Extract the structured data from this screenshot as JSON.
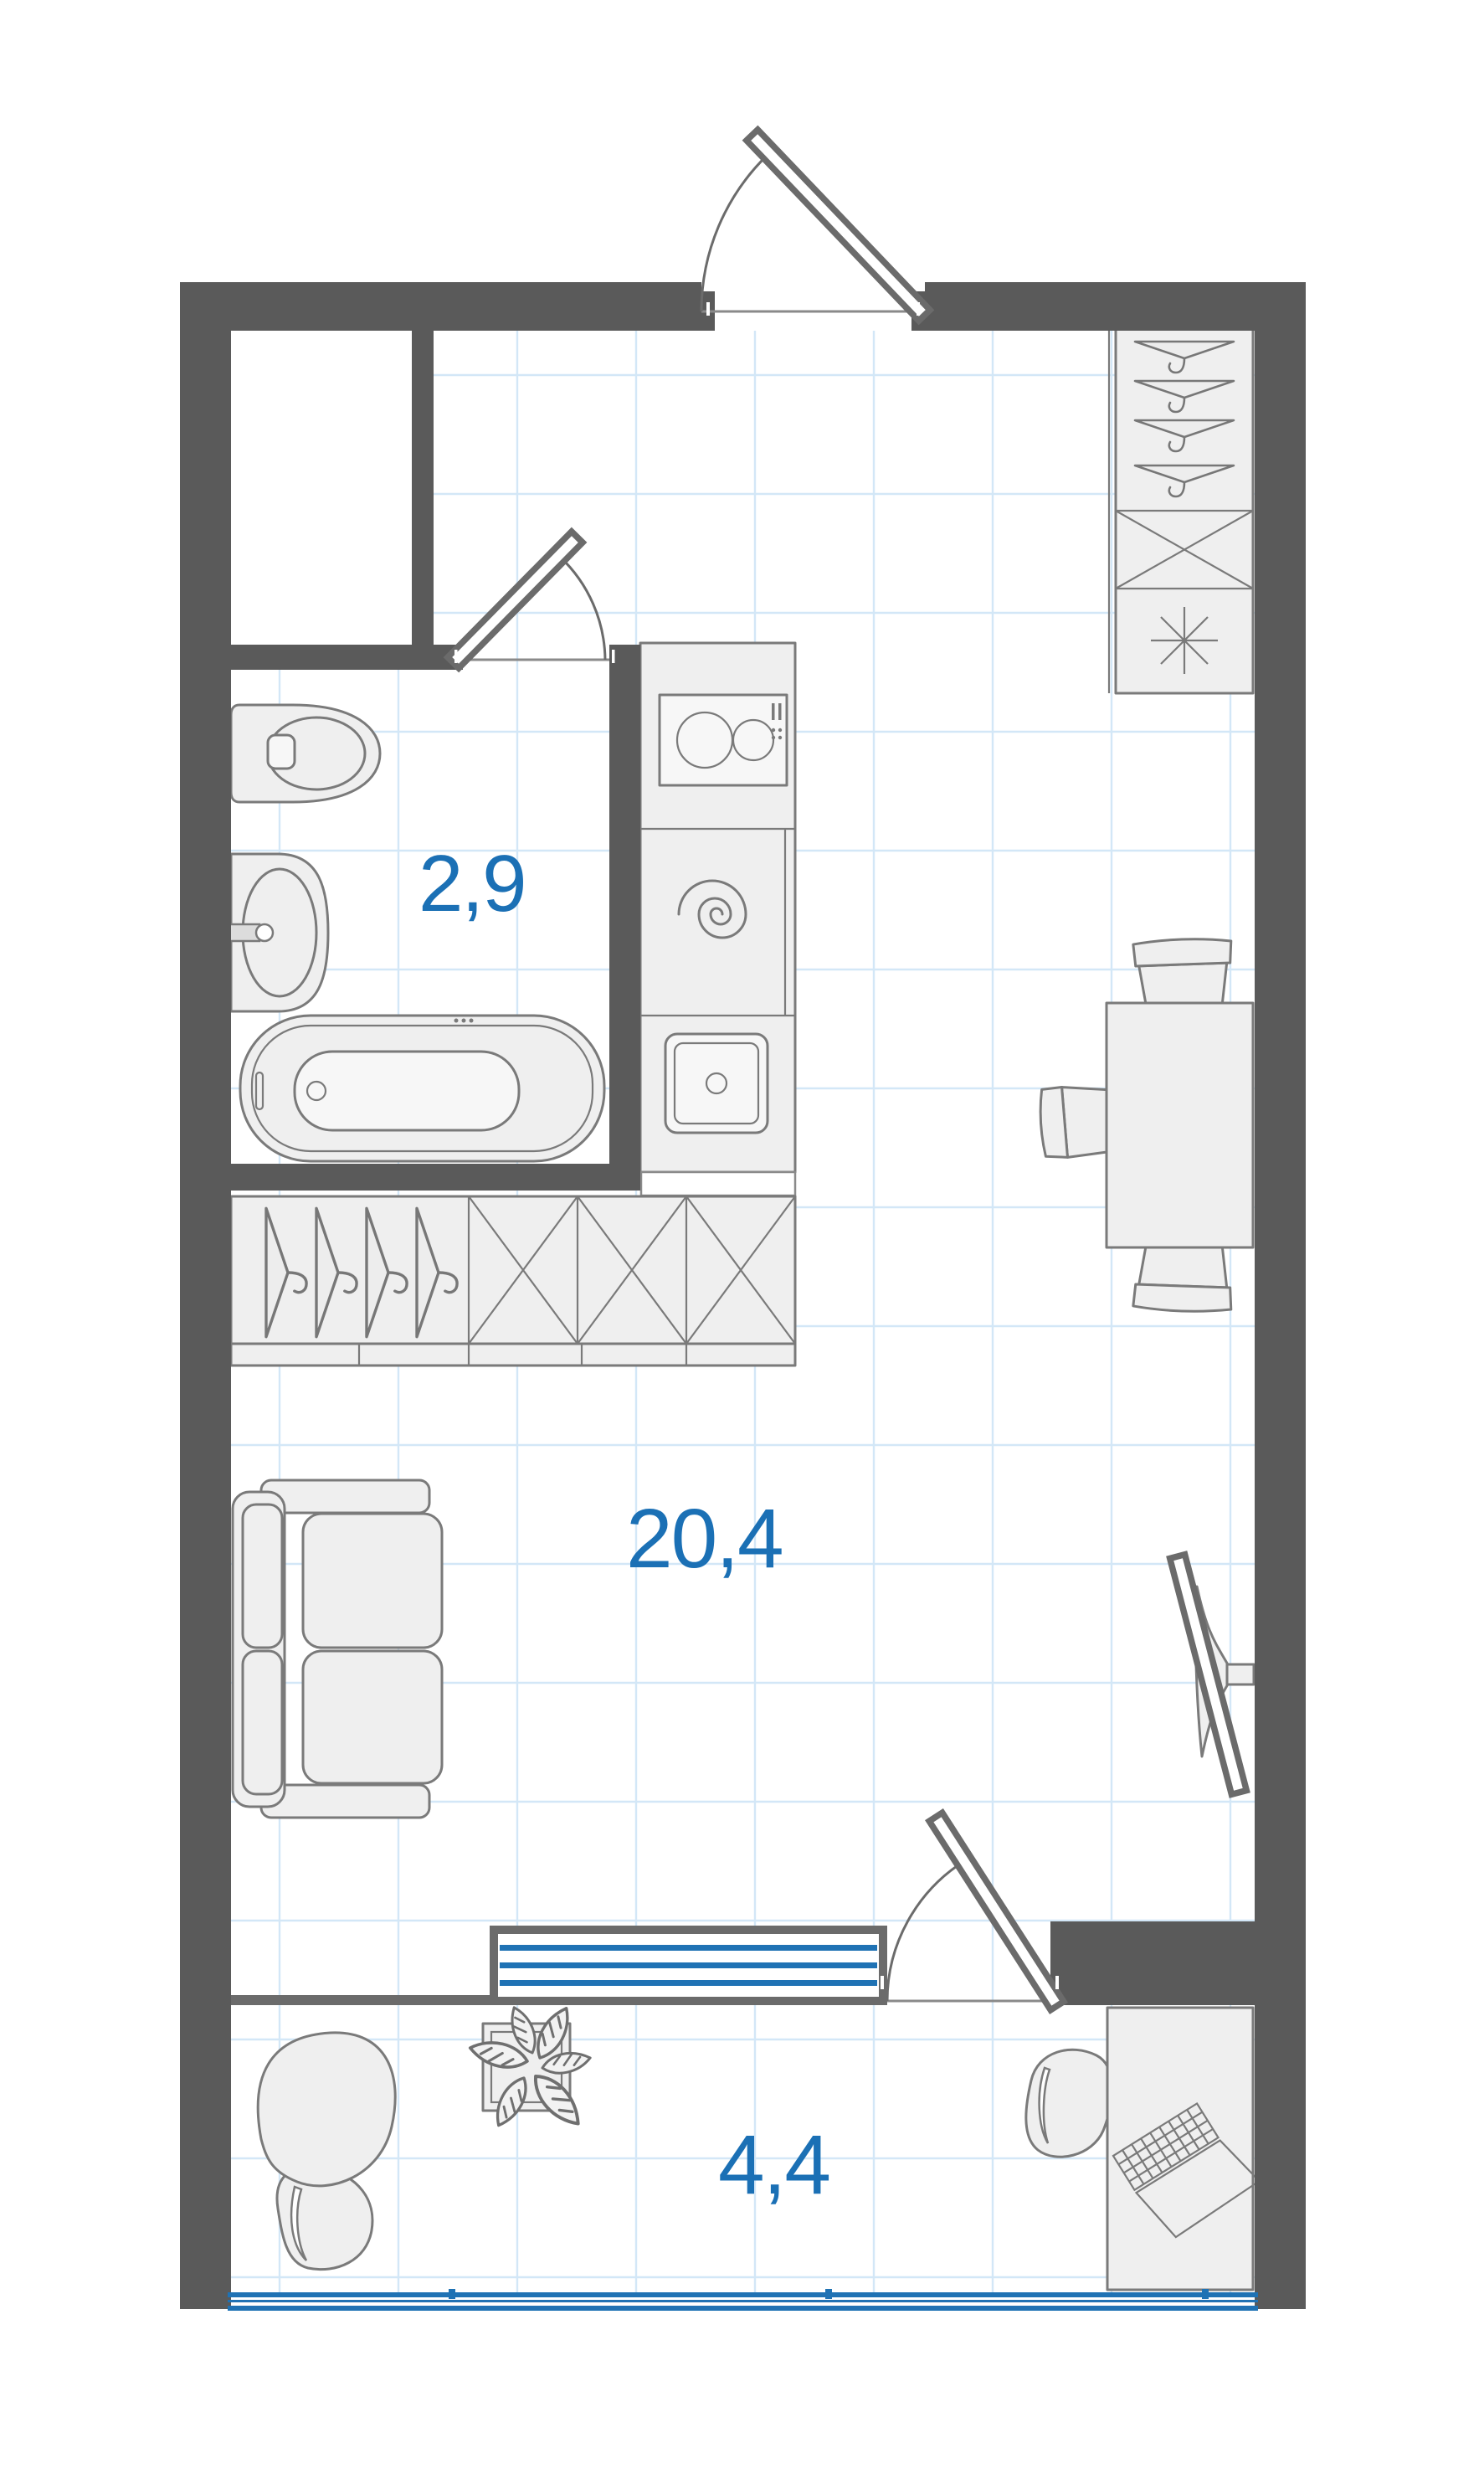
{
  "page": {
    "title": "Studio apartment floor plan"
  },
  "rooms": {
    "bathroom": {
      "name": "bathroom",
      "area_label": "2,9"
    },
    "living_kitchen": {
      "name": "living-kitchen-studio",
      "area_label": "20,4"
    },
    "balcony": {
      "name": "balcony-loggia",
      "area_label": "4,4"
    }
  },
  "colors": {
    "wall": "#5a5a5a",
    "area_label_blue": "#1b70b5",
    "window_blue": "#1f72b4",
    "grid_line": "#d3e7f7",
    "furniture_fill": "#efefef",
    "furniture_stroke": "#7a7a7a"
  },
  "icons": {
    "hanger": "hanger-icon",
    "fridge": "snowflake-fridge-icon",
    "cabinet": "crossed-box-cabinet-icon",
    "stove": "stove-burners-icon",
    "washing_machine": "spiral-washer-icon",
    "kitchen_sink": "kitchen-sink-icon",
    "plant": "plant-icon",
    "laptop": "laptop-icon"
  }
}
